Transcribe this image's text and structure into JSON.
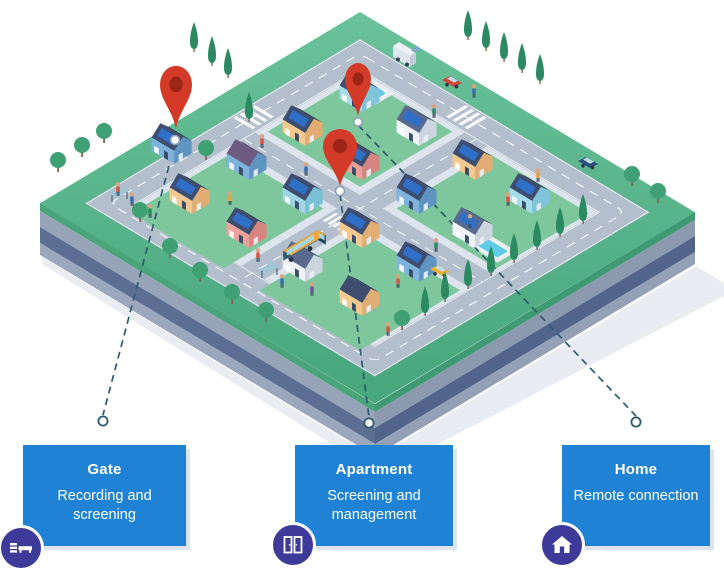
{
  "theme": {
    "card_blue": "#1f82d4",
    "badge_purple": "#3d3a99",
    "pin_red": "#d43a28",
    "connector": "#2c5a70"
  },
  "map": {
    "description": "isometric smart neighborhood illustration",
    "pins": [
      "map-pin-gate",
      "map-pin-apartment",
      "map-pin-home"
    ]
  },
  "cards": [
    {
      "id": "gate",
      "title": "Gate",
      "description": "Recording and screening",
      "icon": "gate-icon"
    },
    {
      "id": "apartment",
      "title": "Apartment",
      "description": "Screening and management",
      "icon": "apartment-icon"
    },
    {
      "id": "home",
      "title": "Home",
      "description": "Remote connection",
      "icon": "home-icon"
    }
  ]
}
